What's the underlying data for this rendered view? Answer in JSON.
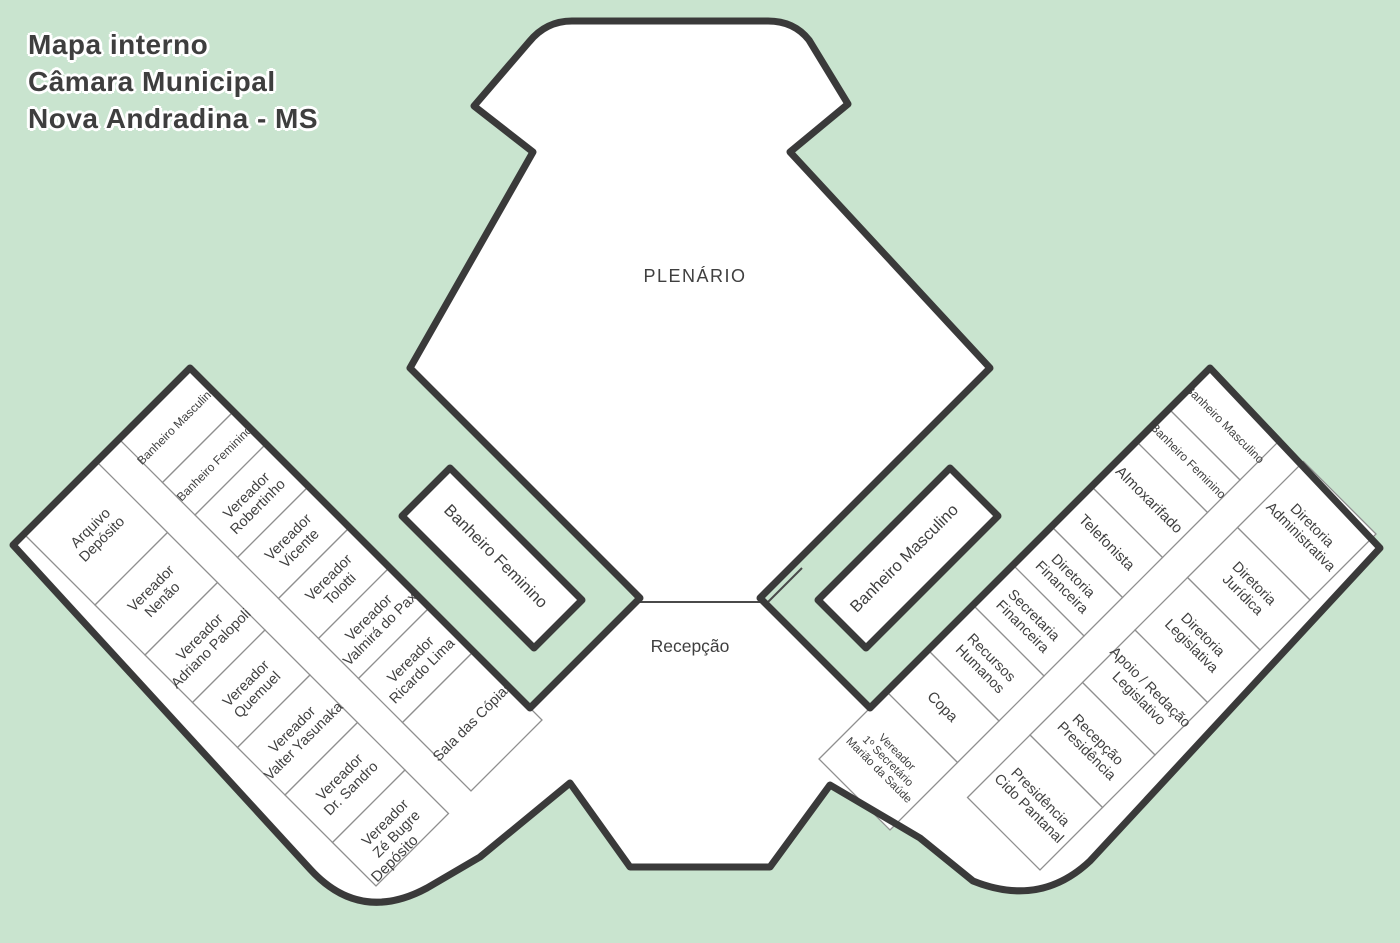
{
  "title": {
    "lines": [
      "Mapa interno",
      "Câmara Municipal",
      "Nova Andradina - MS"
    ]
  },
  "map": {
    "plenario_label": "PLENÁRIO",
    "recepcao_label": "Recepção",
    "left_restroom_block_label": "Banheiro Feminino",
    "right_restroom_block_label": "Banheiro Masculino",
    "left_wing": {
      "inner_rooms": [
        {
          "label": "Banheiro Masculino"
        },
        {
          "label": "Banheiro Feminino"
        },
        {
          "label": "Vereador\nRobertinho"
        },
        {
          "label": "Vereador\nVicente"
        },
        {
          "label": "Vereador\nTolotti"
        },
        {
          "label": "Vereador\nValmirá do Pax"
        },
        {
          "label": "Vereador\nRicardo Lima"
        },
        {
          "label": "Sala das Cópias"
        }
      ],
      "outer_rooms": [
        {
          "label": "Arquivo\nDepósito"
        },
        {
          "label": "Vereador\nNenão"
        },
        {
          "label": "Vereador\nAdriano Palopoli"
        },
        {
          "label": "Vereador\nQuemuel"
        },
        {
          "label": "Vereador\nValter Yasunaka"
        },
        {
          "label": "Vereador\nDr. Sandro"
        },
        {
          "label": "Vereador\nZé Bugre"
        }
      ],
      "end_label": "Depósito"
    },
    "right_wing": {
      "inner_rooms": [
        {
          "label": "Banheiro Masculino"
        },
        {
          "label": "Banheiro Feminino"
        },
        {
          "label": "Almoxarifado"
        },
        {
          "label": "Telefonista"
        },
        {
          "label": "Diretoria\nFinanceira"
        },
        {
          "label": "Secretaria\nFinanceira"
        },
        {
          "label": "Recursos\nHumanos"
        },
        {
          "label": "Copa"
        },
        {
          "label": "Vereador\n1º Secretário\nMarião da Saúde"
        }
      ],
      "outer_rooms": [
        {
          "label": "Diretoria\nAdministrativa"
        },
        {
          "label": "Diretoria\nJurídica"
        },
        {
          "label": "Diretoria\nLegislativa"
        },
        {
          "label": "Apoio / Redação\nLegislativo"
        },
        {
          "label": "Recepção\nPresidência"
        },
        {
          "label": "Presidência\nCido Pantanal"
        }
      ]
    }
  },
  "colors": {
    "background": "#c9e4cf",
    "wall": "#3a3a3a",
    "room_line": "#8f8f8f",
    "room_fill": "#ffffff",
    "label": "#3f3f3f",
    "title": "#3e3e3e",
    "title_outline": "#ffffff"
  }
}
